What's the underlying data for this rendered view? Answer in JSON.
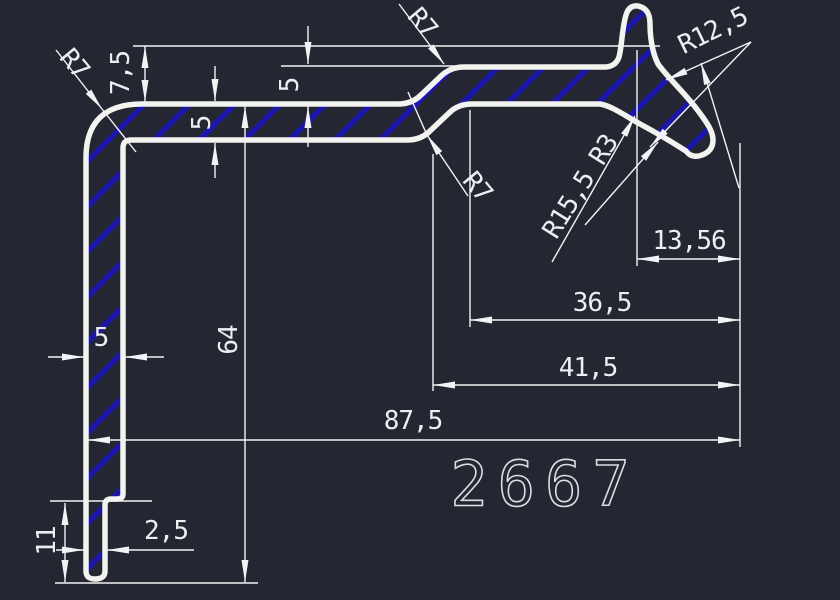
{
  "drawing": {
    "title": "profile-cross-section",
    "part_number": "2667",
    "colors": {
      "background": "#242731",
      "outline": "#f3f3ef",
      "hatch_blue": "#1b16ac",
      "dimension_white": "#f2f3f5"
    },
    "dimensions": {
      "top_offset": "7,5",
      "wall_top": "5",
      "jog_offset": "5",
      "hook_tip_width": "13,56",
      "hook_to_jog_top": "36,5",
      "hook_to_jog_bottom": "41,5",
      "overall_width": "87,5",
      "overall_height": "64",
      "wall_left": "5",
      "bottom_lip_width": "2,5",
      "bottom_lip_height": "11"
    },
    "radii": {
      "corner_top_left": "R7",
      "jog_upper": "R7",
      "jog_lower": "R7",
      "hook_outer": "R12,5",
      "hook_inner": "R15,5",
      "crotch_fillet": "R3"
    }
  }
}
